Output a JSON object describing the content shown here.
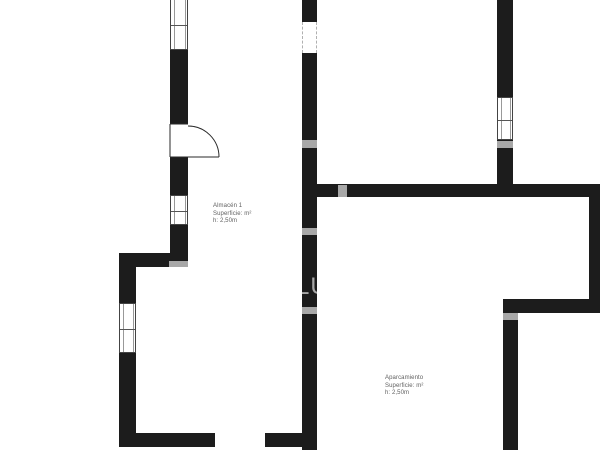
{
  "plan": {
    "canvas": {
      "width": 600,
      "height": 450
    },
    "colors": {
      "background": "#ffffff",
      "wall": "#1c1c1c",
      "window_frame": "#444444",
      "window_glass_line": "#999999",
      "door_line": "#2a2a2a",
      "dashed_opening": "#b0b0b0",
      "label_text": "#5f5f5f",
      "watermark": "#a8a8a8"
    },
    "walls": [
      {
        "x": 170,
        "y": 50,
        "w": 18,
        "h": 74
      },
      {
        "x": 170,
        "y": 157,
        "w": 18,
        "h": 38
      },
      {
        "x": 170,
        "y": 225,
        "w": 18,
        "h": 42
      },
      {
        "x": 119,
        "y": 253,
        "w": 69,
        "h": 14
      },
      {
        "x": 119,
        "y": 267,
        "w": 17,
        "h": 36
      },
      {
        "x": 119,
        "y": 353,
        "w": 17,
        "h": 94
      },
      {
        "x": 119,
        "y": 433,
        "w": 96,
        "h": 14
      },
      {
        "x": 265,
        "y": 433,
        "w": 52,
        "h": 14
      },
      {
        "x": 302,
        "y": 0,
        "w": 15,
        "h": 22
      },
      {
        "x": 302,
        "y": 53,
        "w": 15,
        "h": 397
      },
      {
        "x": 317,
        "y": 184,
        "w": 283,
        "h": 13
      },
      {
        "x": 497,
        "y": 0,
        "w": 16,
        "h": 97
      },
      {
        "x": 497,
        "y": 140,
        "w": 16,
        "h": 44
      },
      {
        "x": 589,
        "y": 184,
        "w": 11,
        "h": 129
      },
      {
        "x": 503,
        "y": 299,
        "w": 97,
        "h": 14
      },
      {
        "x": 503,
        "y": 313,
        "w": 15,
        "h": 137
      }
    ],
    "windows": [
      {
        "x": 170,
        "y": 0,
        "w": 18,
        "h": 50,
        "open_top": true
      },
      {
        "x": 170,
        "y": 195,
        "w": 18,
        "h": 30
      },
      {
        "x": 119,
        "y": 303,
        "w": 17,
        "h": 50
      },
      {
        "x": 497,
        "y": 97,
        "w": 16,
        "h": 43
      }
    ],
    "dashed_openings": [
      {
        "x": 302,
        "y": 22,
        "w": 15,
        "h": 31
      }
    ],
    "door": {
      "hinge": {
        "x": 188,
        "y": 157
      },
      "radius": 31,
      "leaf": {
        "x1": 170,
        "y1": 157,
        "x2": 219,
        "y2": 157
      },
      "caps": [
        {
          "x1": 170,
          "y1": 124,
          "x2": 188,
          "y2": 124
        },
        {
          "x1": 170,
          "y1": 124,
          "x2": 170,
          "y2": 157
        }
      ]
    },
    "watermark": {
      "text": "LU",
      "text_pos": {
        "x": 296,
        "y": 275
      },
      "bands": [
        {
          "x": 302,
          "y": 140,
          "w": 15,
          "h": 8
        },
        {
          "x": 497,
          "y": 141,
          "w": 16,
          "h": 7
        },
        {
          "x": 338,
          "y": 185,
          "w": 9,
          "h": 12
        },
        {
          "x": 302,
          "y": 228,
          "w": 15,
          "h": 7
        },
        {
          "x": 169,
          "y": 261,
          "w": 19,
          "h": 6
        },
        {
          "x": 302,
          "y": 307,
          "w": 15,
          "h": 7
        },
        {
          "x": 503,
          "y": 313,
          "w": 15,
          "h": 7
        }
      ]
    }
  },
  "rooms": [
    {
      "name": "Almacén 1",
      "area_label": "Superficie: m²",
      "height_label": "h: 2,50m",
      "pos": {
        "x": 213,
        "y": 203
      }
    },
    {
      "name": "Aparcamiento",
      "area_label": "Superficie: m²",
      "height_label": "h: 2,50m",
      "pos": {
        "x": 385,
        "y": 375
      }
    }
  ]
}
